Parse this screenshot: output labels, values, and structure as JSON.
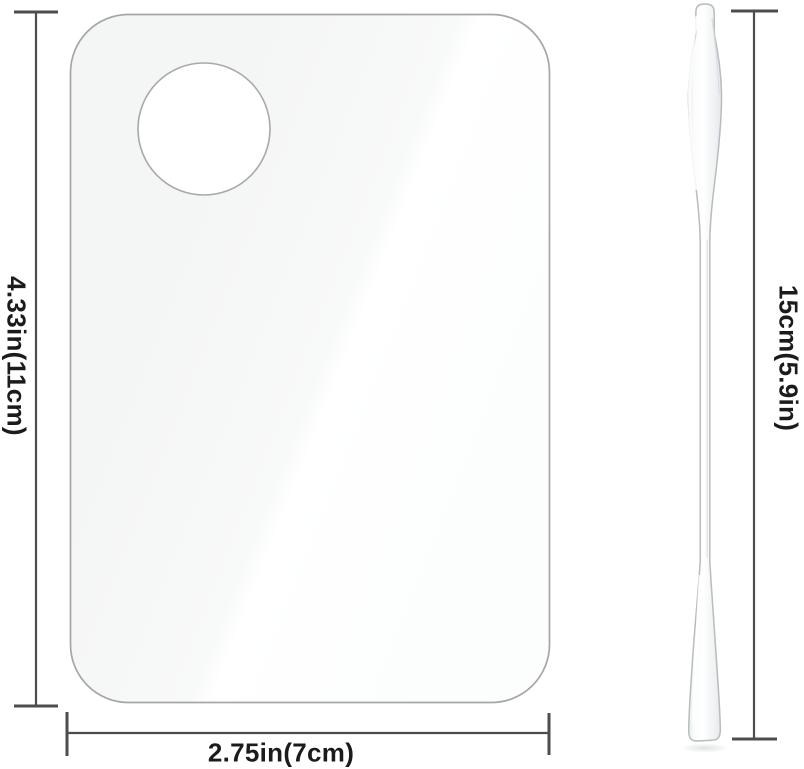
{
  "diagram": {
    "labels": {
      "palette_height": "4.33in(11cm)",
      "palette_width": "2.75in(7cm)",
      "spatula_length": "15cm(5.9in)"
    },
    "colors": {
      "background": "#ffffff",
      "dimension_line": "#4d4d4d",
      "label_text": "#1b1b1b",
      "palette_outline": "#a6a6a6",
      "palette_fill": "#f7f8f8",
      "palette_highlight": "#ffffff",
      "hole_fill": "#ffffff",
      "hole_outline": "#a9a9a9",
      "spatula_outline": "#b7bcbe",
      "spatula_fill": "#f4f6f6"
    }
  }
}
